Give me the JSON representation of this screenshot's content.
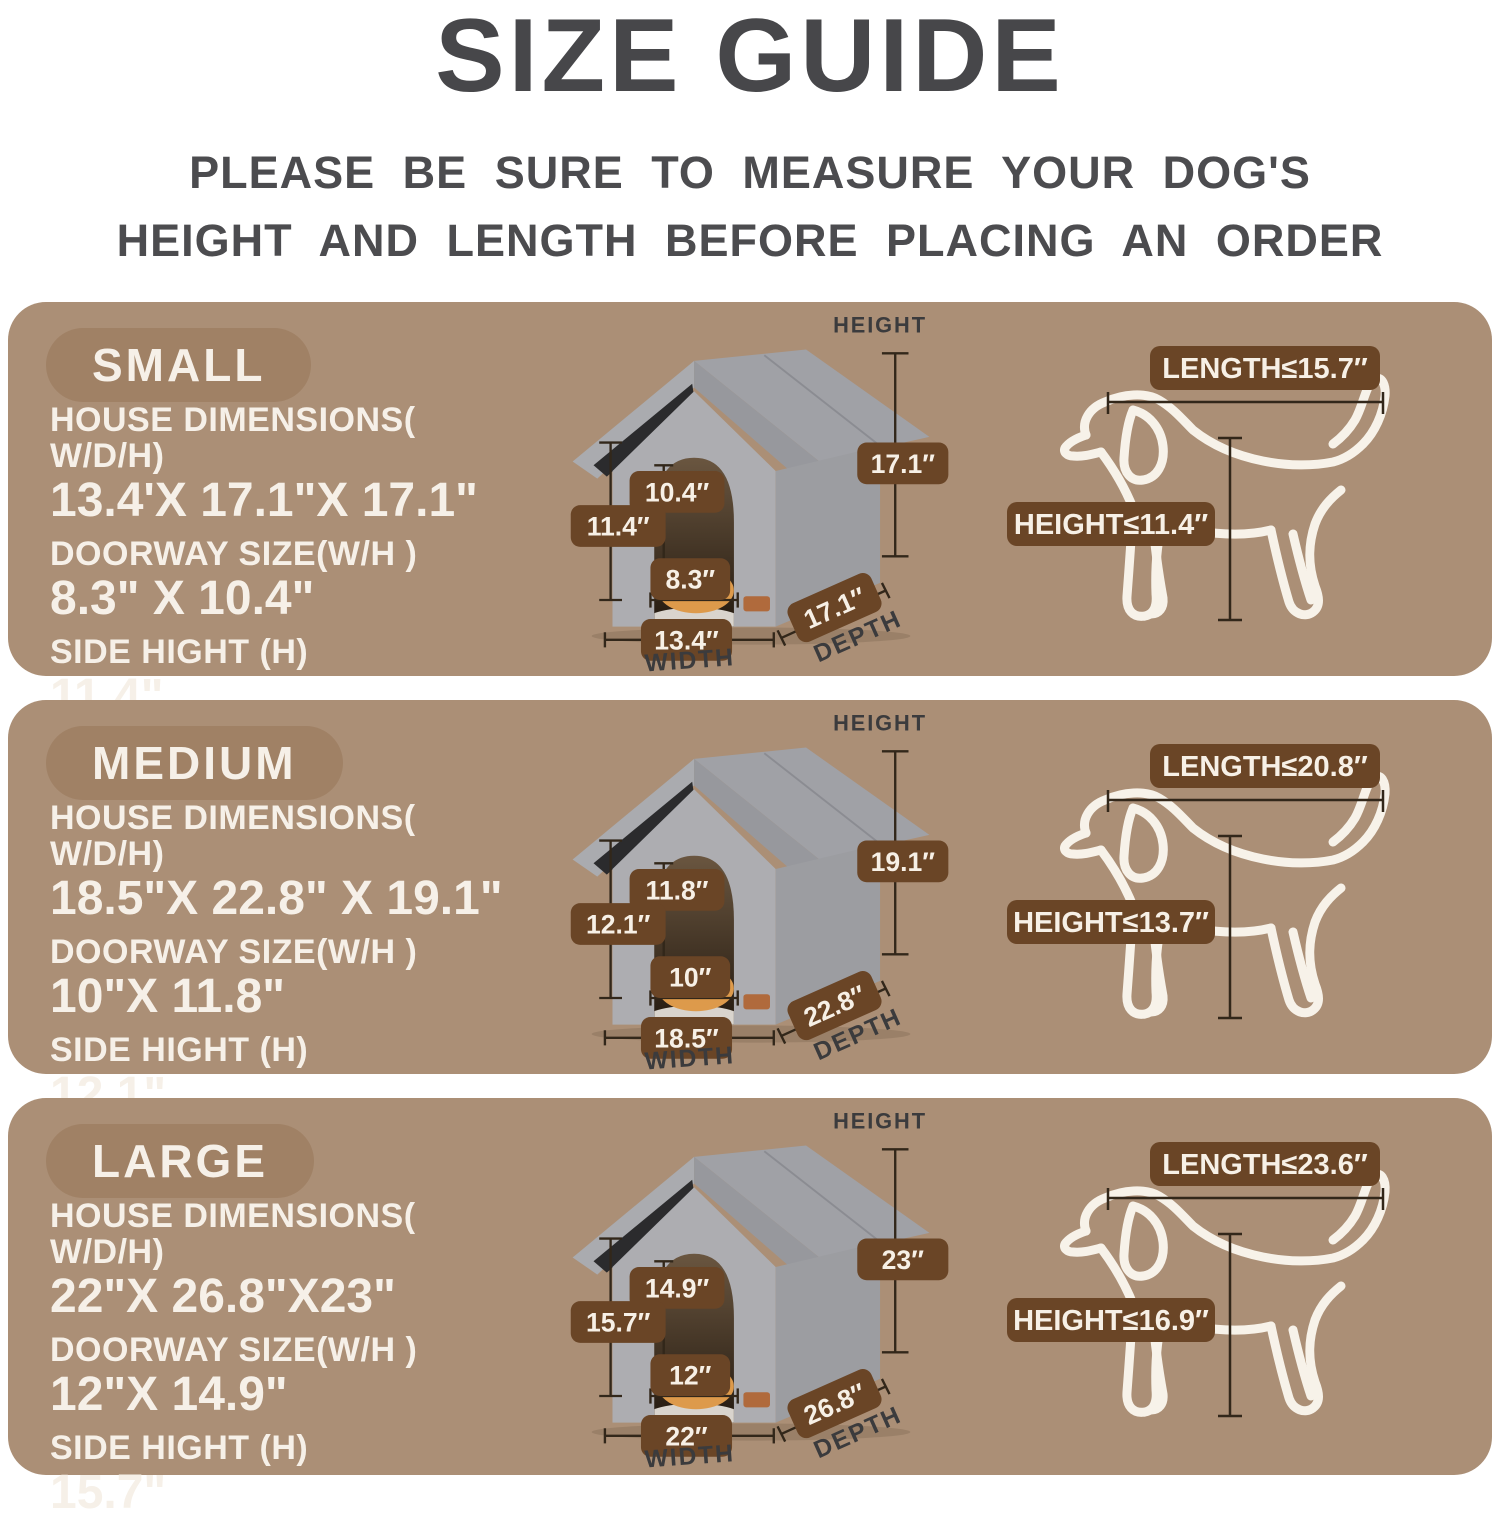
{
  "title": "SIZE GUIDE",
  "subtitle_line1": "PLEASE BE SURE TO MEASURE YOUR DOG'S",
  "subtitle_line2": "HEIGHT AND LENGTH BEFORE PLACING AN ORDER",
  "labels": {
    "house_dims": "HOUSE DIMENSIONS( W/D/H)",
    "doorway": "DOORWAY SIZE(W/H )",
    "side": "SIDE HIGHT (H)",
    "height": "HEIGHT",
    "width": "WIDTH",
    "depth": "DEPTH"
  },
  "colors": {
    "panel_bg": "#ab8f76",
    "size_pill_bg": "#a08165",
    "dim_badge_bg": "#6a4526",
    "panel_text": "#f6f0e8",
    "heading_text": "#47474a",
    "dim_line": "#32271a",
    "house_gray": "#a0a1a6",
    "dog_outline": "#f7f2e9"
  },
  "sizes": [
    {
      "name": "SMALL",
      "house_dims": "13.4'X 17.1\"X 17.1\"",
      "doorway": "8.3\" X 10.4\"",
      "side": "11.4\"",
      "ann": {
        "height": "17.1″",
        "door_h": "10.4″",
        "side_h": "11.4″",
        "door_w": "8.3″",
        "width": "13.4″",
        "depth": "17.1″"
      },
      "dog": {
        "length": "LENGTH≤15.7″",
        "height": "HEIGHT≤11.4″"
      }
    },
    {
      "name": "MEDIUM",
      "house_dims": "18.5\"X 22.8\" X 19.1\"",
      "doorway": "10\"X 11.8\"",
      "side": "12.1\"",
      "ann": {
        "height": "19.1″",
        "door_h": "11.8″",
        "side_h": "12.1″",
        "door_w": "10″",
        "width": "18.5″",
        "depth": "22.8″"
      },
      "dog": {
        "length": "LENGTH≤20.8″",
        "height": "HEIGHT≤13.7″"
      }
    },
    {
      "name": "LARGE",
      "house_dims": "22\"X 26.8\"X23\"",
      "doorway": "12\"X 14.9\"",
      "side": "15.7\"",
      "ann": {
        "height": "23″",
        "door_h": "14.9″",
        "side_h": "15.7″",
        "door_w": "12″",
        "width": "22″",
        "depth": "26.8″"
      },
      "dog": {
        "length": "LENGTH≤23.6″",
        "height": "HEIGHT≤16.9″"
      }
    }
  ]
}
